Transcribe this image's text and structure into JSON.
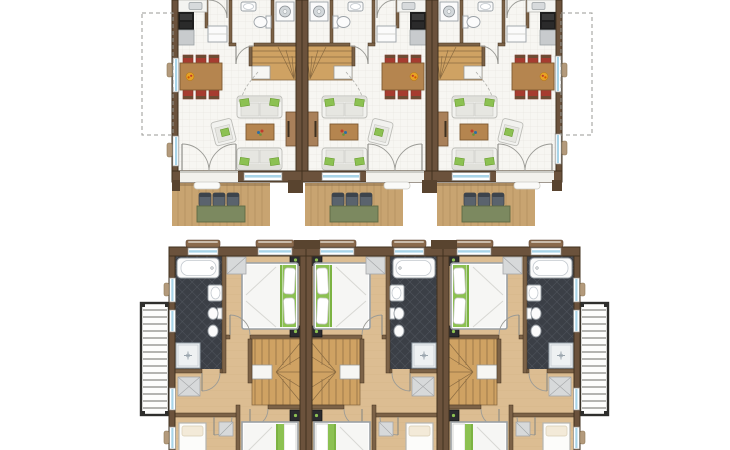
{
  "figure": {
    "type": "architectural-floor-plans",
    "floors": [
      {
        "id": "ground-floor",
        "units": 3,
        "elements": [
          "kitchen-counter",
          "stove",
          "washing-machine",
          "wc-toilet",
          "washbasin",
          "entrance-door",
          "wardrobe",
          "winder-stairs",
          "dining-table",
          "dining-chairs",
          "fruit-bowl",
          "sofa",
          "armchair",
          "coffee-table",
          "tv-sideboard",
          "french-doors",
          "windows",
          "terrace-deck",
          "terrace-chairs",
          "terrace-table",
          "extension-dashed-outline"
        ]
      },
      {
        "id": "upper-floor",
        "units": 3,
        "elements": [
          "double-bed",
          "single-bed",
          "nightstand",
          "wardrobe",
          "bathtub",
          "washbasin",
          "toilet",
          "bidet",
          "shower",
          "winder-stairs",
          "doors",
          "windows",
          "balcony-left",
          "balcony-right"
        ]
      }
    ],
    "colors": {
      "background": "#ffffff",
      "wall": "#6b523c",
      "wall_stroke": "#42311f",
      "wall_dark": "#59442f",
      "interior_wall": "#7c6247",
      "floor_cream": "#f7f6f2",
      "floor_grid": "#e9e8e2",
      "wood_floor": "#dcbd92",
      "wood_plank_line": "#cba87b",
      "wood_stairs": "#cfa263",
      "wood_deck": "#c8a471",
      "wood_furniture": "#b5854f",
      "bath_tile": "#3b3f46",
      "bath_tile_line": "#565b64",
      "accent_green": "#8cc152",
      "dining_chair_red": "#a63c30",
      "terrace_chair_gray": "#5a636d",
      "terrace_table_green": "#7c8960",
      "window_blue": "#a8d4e8",
      "fixture_white": "#fbfbfb",
      "counter_black": "#1e1e1e",
      "appliance_silver": "#c8cbcd",
      "balcony_rail_dark": "#2e2e2c",
      "dashed_outline_gray": "#9a9a94"
    }
  }
}
